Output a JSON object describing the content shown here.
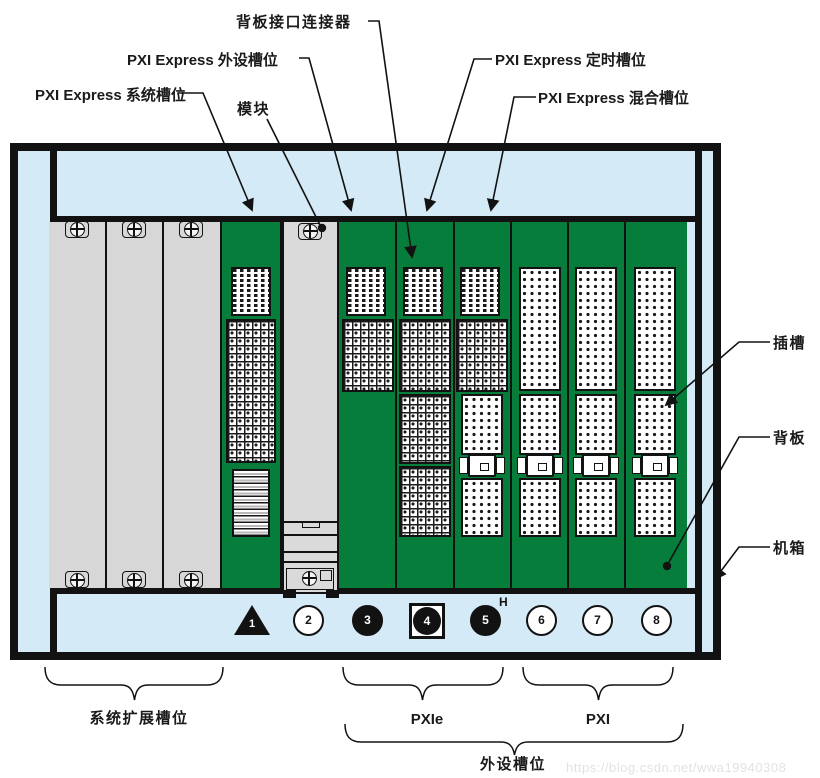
{
  "callouts": {
    "backplane_connector": "背板接口连接器",
    "pxie_peripheral": "PXI Express 外设槽位",
    "pxie_system": "PXI Express 系统槽位",
    "module": "模块",
    "pxie_timing": "PXI Express 定时槽位",
    "pxie_hybrid": "PXI Express 混合槽位",
    "slot": "插槽",
    "backplane": "背板",
    "chassis": "机箱"
  },
  "groups": {
    "system_expansion": "系统扩展槽位",
    "pxie": "PXIe",
    "pxi": "PXI",
    "peripheral": "外设槽位"
  },
  "slots": [
    {
      "number": "1",
      "symbol": "black-triangle"
    },
    {
      "number": "2",
      "symbol": "white-circle"
    },
    {
      "number": "3",
      "symbol": "black-circle"
    },
    {
      "number": "4",
      "symbol": "black-circle-in-square"
    },
    {
      "number": "5",
      "symbol": "black-circle",
      "marker": "H"
    },
    {
      "number": "6",
      "symbol": "white-circle"
    },
    {
      "number": "7",
      "symbol": "white-circle"
    },
    {
      "number": "8",
      "symbol": "white-circle"
    }
  ],
  "hybrid_marker": "H",
  "watermark": "https://blog.csdn.net/wwa19940308",
  "colors": {
    "chassis_blue": "#d5eaf7",
    "backplane_green": "#077d3c",
    "panel_gray": "#d7d7d7",
    "line_black": "#121212"
  }
}
